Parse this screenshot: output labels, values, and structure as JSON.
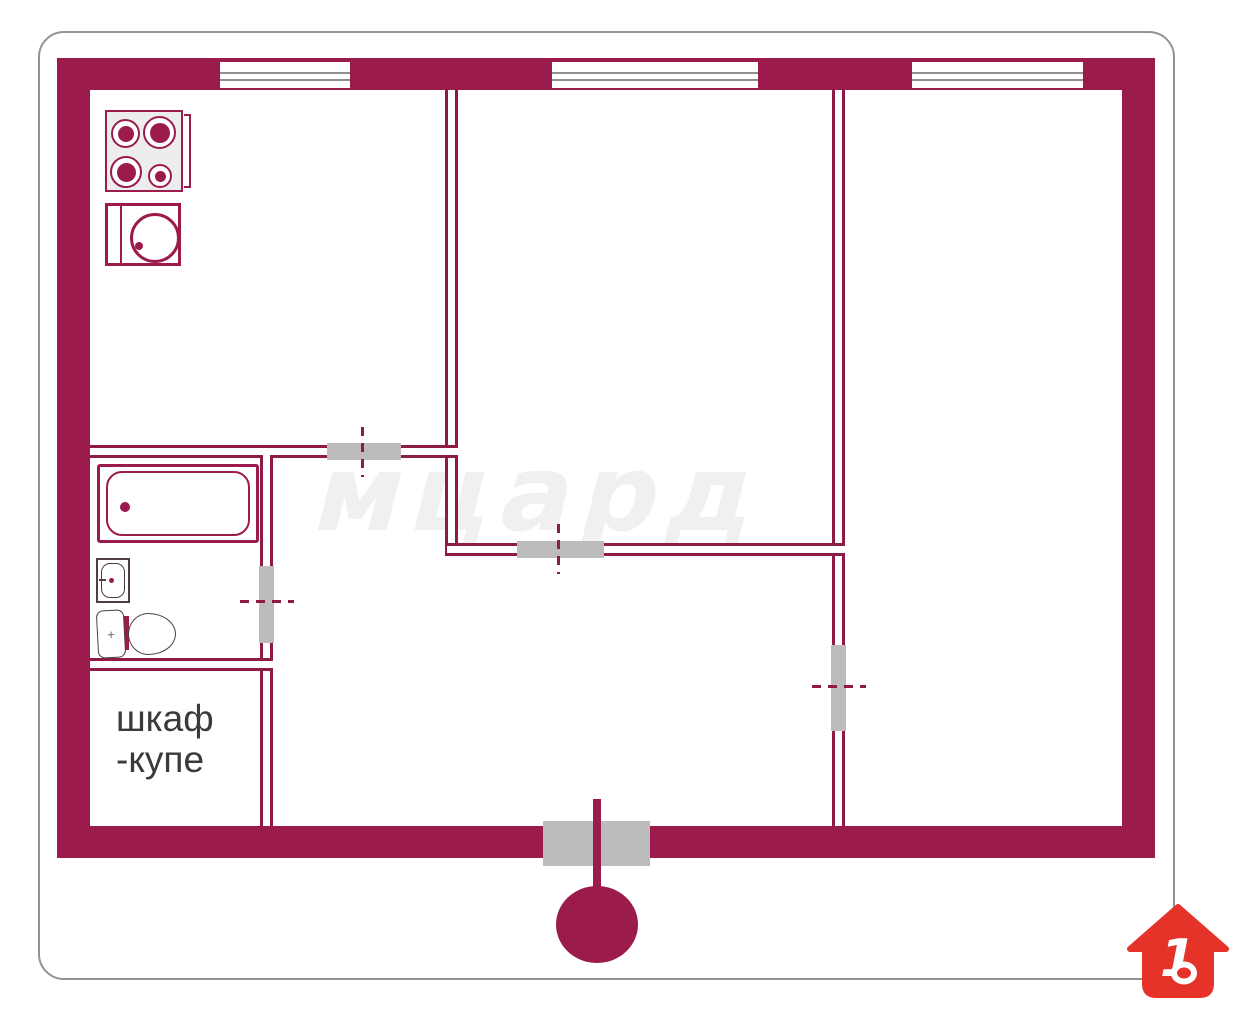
{
  "watermark": {
    "text": "мцард"
  },
  "closet_label": {
    "line1": "шкаф",
    "line2": "-купе"
  },
  "logo": {
    "number": "1"
  },
  "colors": {
    "wall": "#9b1b4c",
    "interior_line": "#8e1a46",
    "door_block": "#bcbcbc",
    "logo_red": "#e5332a",
    "watermark": "#f0f0f0",
    "label_text": "#3a3a3a",
    "fixture_line": "#4d3d45",
    "window_line": "#909090",
    "card_border": "#979097"
  },
  "fixtures": {
    "icons": [
      "stove-icon",
      "washing-machine-icon",
      "bathtub-icon",
      "sink-icon",
      "toilet-icon",
      "window-icon",
      "door-opening",
      "entrance-marker-icon",
      "house-logo-icon"
    ]
  }
}
